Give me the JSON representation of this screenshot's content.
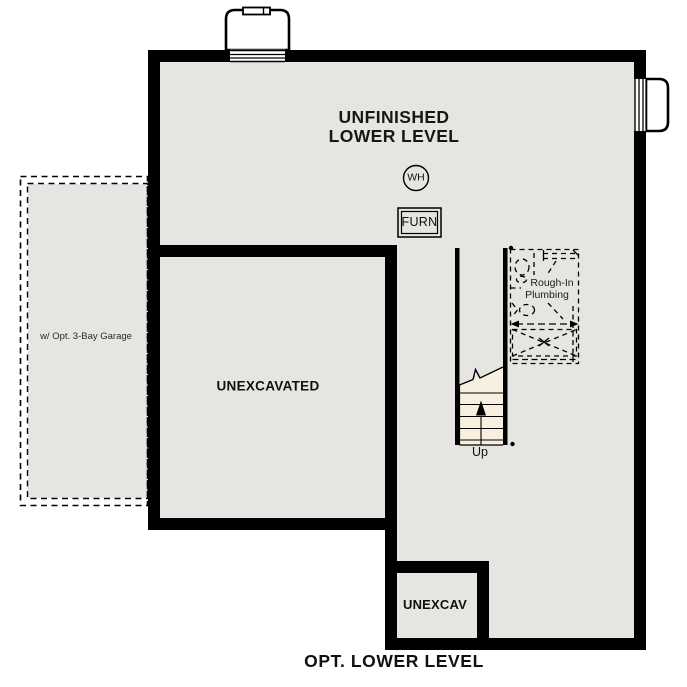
{
  "plan_title": "OPT. LOWER LEVEL",
  "rooms": {
    "unfinished_lower_level": {
      "label_line1": "UNFINISHED",
      "label_line2": "LOWER LEVEL"
    },
    "unexcavated": {
      "label": "UNEXCAVATED"
    },
    "unexcav": {
      "label": "UNEXCAV"
    },
    "garage": {
      "label": "w/ Opt. 3-Bay Garage"
    }
  },
  "equipment": {
    "water_heater": {
      "label": "WH"
    },
    "furnace": {
      "label": "FURN"
    }
  },
  "plumbing": {
    "label_line1": "Rough-In",
    "label_line2": "Plumbing"
  },
  "stairs": {
    "label": "Up"
  },
  "colors": {
    "floor_gray": "#e7e5e2",
    "wall_black": "#000000",
    "stair_beige": "#f8f0df",
    "well_white": "#ffffff"
  }
}
